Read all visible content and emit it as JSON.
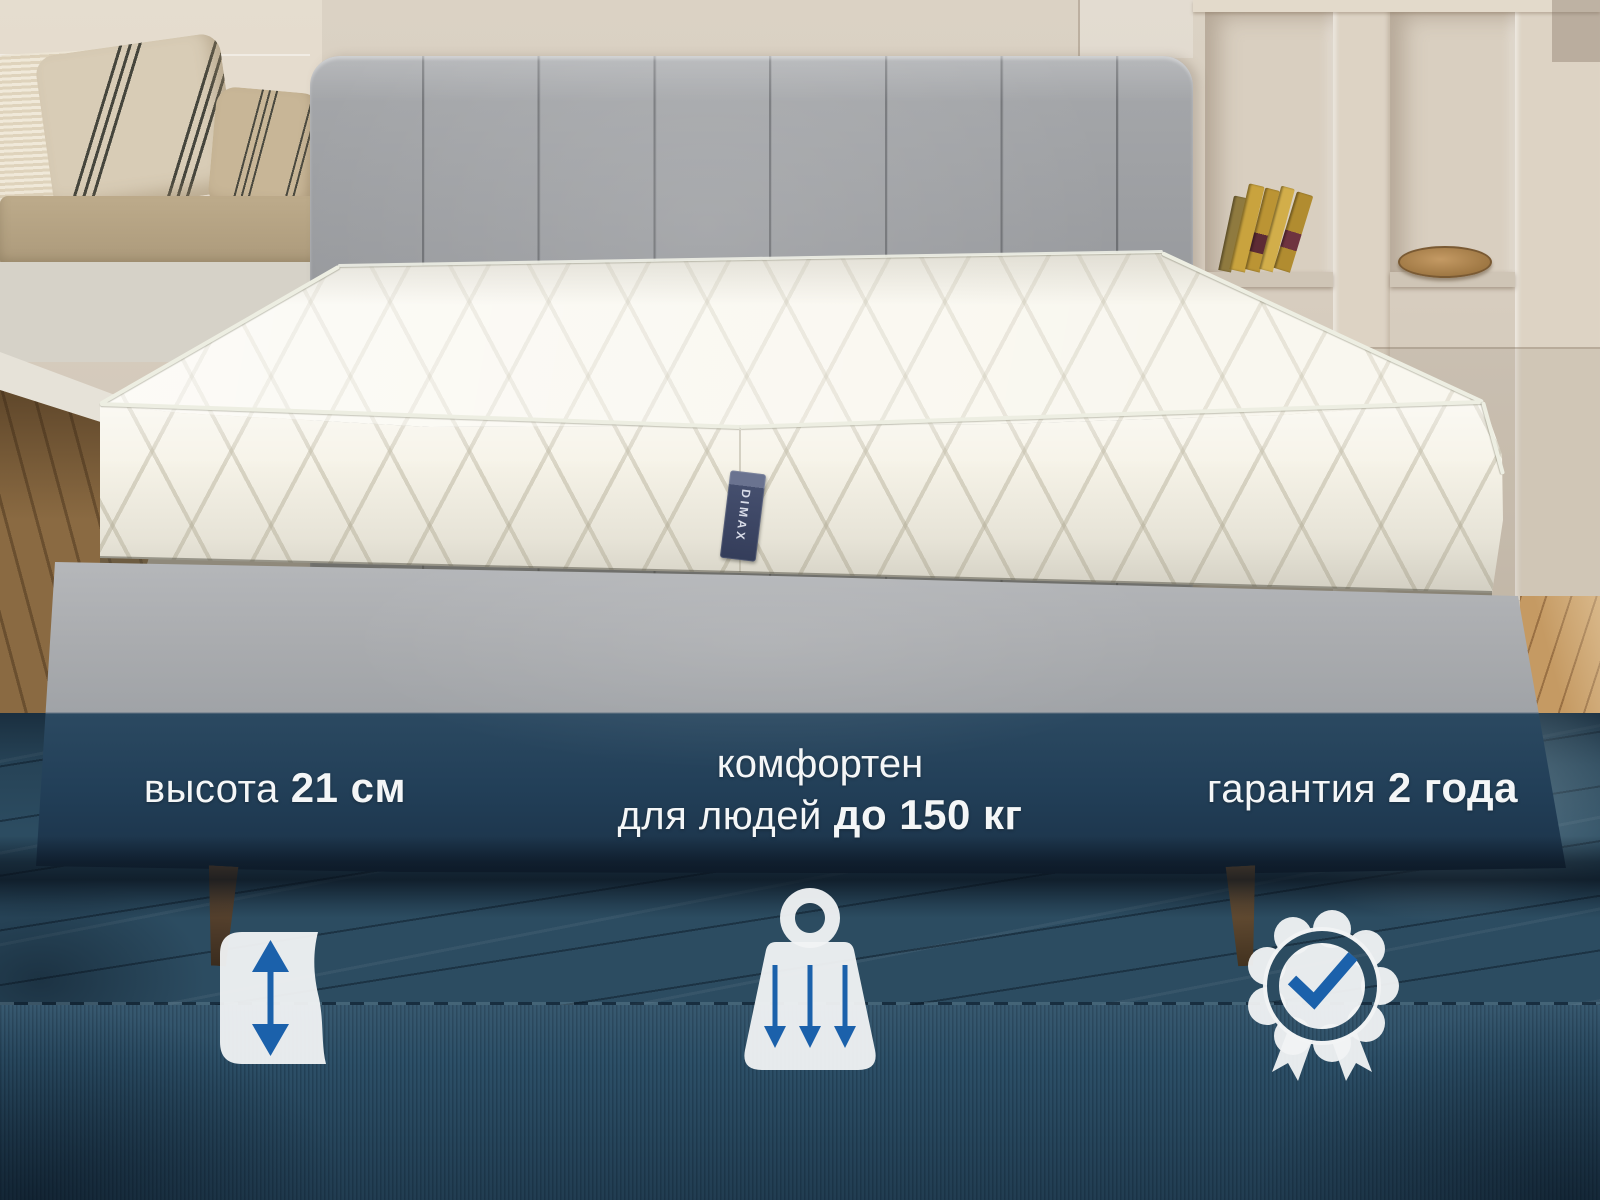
{
  "brand": {
    "label": "DIMAX"
  },
  "features": {
    "height": {
      "regular": "высота",
      "bold": "21 см",
      "icon": "height-arrows"
    },
    "comfort": {
      "line1": "комфортен",
      "regular": "для людей",
      "bold": "до 150 кг",
      "icon": "weight-arrows"
    },
    "warranty": {
      "regular": "гарантия",
      "bold": "2 года",
      "icon": "rosette-check"
    }
  },
  "colors": {
    "accent_blue": "#1b61ab",
    "overlay_navy": "#27465f",
    "icon_white": "#f1f3f4",
    "text_white": "#f4f6f7"
  }
}
